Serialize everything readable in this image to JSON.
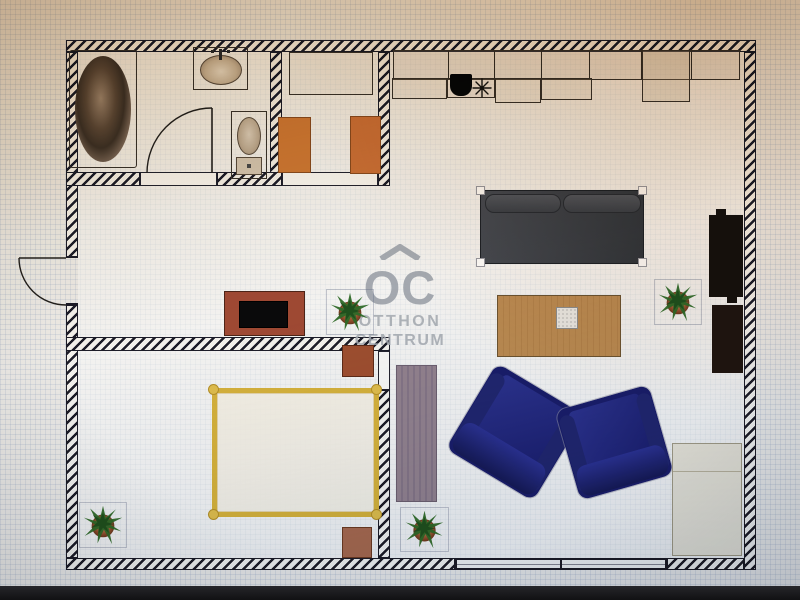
{
  "watermark": {
    "abbr": "OC",
    "line1": "OTTHON",
    "line2": "CENTRUM",
    "roof_icon": "house-roof-icon"
  },
  "plan": {
    "description": "2D apartment floor plan, top view, photographed on a screen",
    "entrance": "left-wall-swing-out-door",
    "rooms": [
      {
        "name": "bathroom",
        "position": "top-left",
        "fixtures": [
          "bathtub",
          "washbasin",
          "toilet",
          "swing-door"
        ]
      },
      {
        "name": "entry-storage",
        "position": "top-middle",
        "fixtures": [
          "cabinet-outline",
          "orange-wardrobe-left",
          "orange-wardrobe-right",
          "door-sill"
        ]
      },
      {
        "name": "hallway",
        "position": "middle-left",
        "fixtures": [
          "tv-sideboard-red",
          "potted-plant"
        ]
      },
      {
        "name": "bedroom",
        "position": "bottom-left",
        "fixtures": [
          "double-bed-yellow-frame",
          "nightstand-upper",
          "nightstand-lower",
          "potted-plant"
        ]
      },
      {
        "name": "living-room-with-kitchen",
        "position": "right",
        "fixtures": [
          "kitchen-counter-run",
          "kitchen-sink",
          "cooktop",
          "gray-sofa",
          "coffee-table",
          "white-side-table",
          "media-unit-upper",
          "media-unit-lower",
          "blue-armchair-left",
          "blue-armchair-right",
          "striped-runner-rug",
          "low-wardrobe-beige",
          "potted-plant-mid",
          "potted-plant-lower",
          "bottom-window-left",
          "bottom-window-right"
        ]
      }
    ]
  },
  "colors": {
    "wall_line": "#1c1c28",
    "floor": "#f4f3f0",
    "grid_line": "#7d94ba",
    "sofa_gray": "#3c3f45",
    "armchair_blue": "#1d2178",
    "bed_frame_yellow": "#d9b33c",
    "coffee_table_tan": "#bd8c52",
    "orange_wardrobe": "#cf7a33",
    "tv_sideboard_red": "#a14a34",
    "nightstand_sienna": "#a35130",
    "rug_mauve": "#94838f",
    "wardrobe_beige": "#eae5d7",
    "plant_green": "#2f6b28",
    "pot_terracotta": "#a9633a",
    "watermark_gray": "#9aa0a8",
    "photo_cast_warm": "#be8c56",
    "photo_cast_cool": "#96a8c4",
    "bottom_band": "#17171a"
  }
}
